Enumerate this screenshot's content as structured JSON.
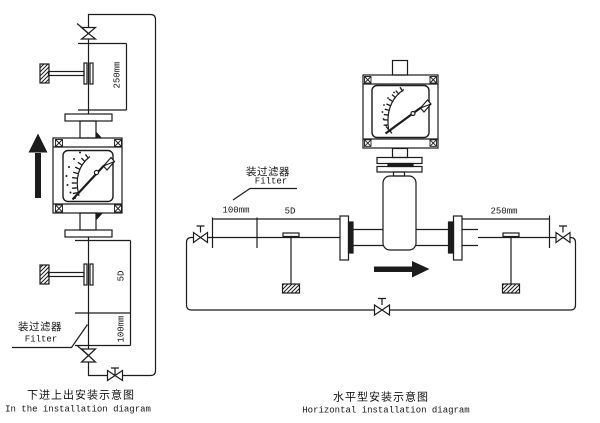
{
  "canvas": {
    "background": "#ffffff",
    "ink": "#1c1c1c"
  },
  "left_diagram": {
    "caption_zh": "下进上出安装示意图",
    "caption_en": "In the installation diagram",
    "filter_label_zh": "装过滤器",
    "filter_label_en": "Filter",
    "dims": {
      "outlet": "250mm",
      "straight": "5D",
      "filter": "100mm"
    }
  },
  "right_diagram": {
    "caption_zh": "水平型安装示意图",
    "caption_en": "Horizontal installation diagram",
    "filter_label_zh": "装过滤器",
    "filter_label_en": "Filter",
    "dims": {
      "filter": "100mm",
      "straight": "5D",
      "outlet": "250mm"
    }
  }
}
